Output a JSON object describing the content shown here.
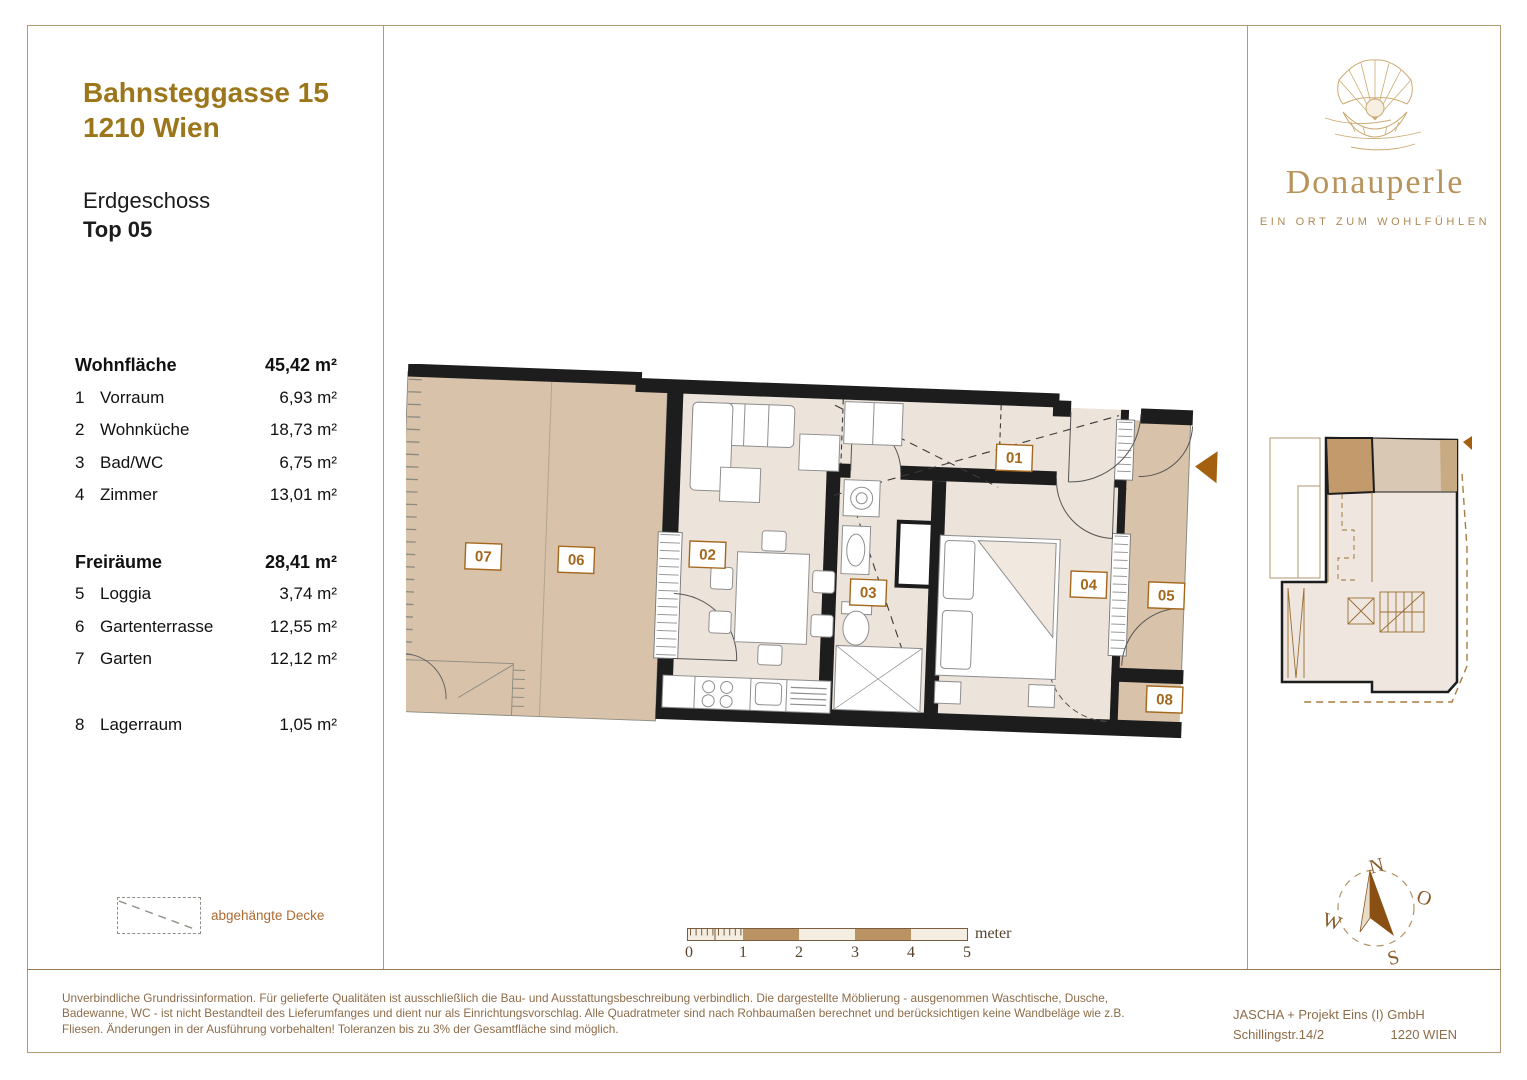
{
  "header": {
    "address_line1": "Bahnsteggasse 15",
    "address_line2": "1210 Wien",
    "floor": "Erdgeschoss",
    "unit": "Top 05"
  },
  "areas": {
    "living": {
      "label": "Wohnfläche",
      "total": "45,42 m²",
      "rows": [
        {
          "no": "1",
          "name": "Vorraum",
          "area": "6,93 m²"
        },
        {
          "no": "2",
          "name": "Wohnküche",
          "area": "18,73 m²"
        },
        {
          "no": "3",
          "name": "Bad/WC",
          "area": "6,75 m²"
        },
        {
          "no": "4",
          "name": "Zimmer",
          "area": "13,01 m²"
        }
      ]
    },
    "open": {
      "label": "Freiräume",
      "total": "28,41 m²",
      "rows": [
        {
          "no": "5",
          "name": "Loggia",
          "area": "3,74 m²"
        },
        {
          "no": "6",
          "name": "Gartenterrasse",
          "area": "12,55 m²"
        },
        {
          "no": "7",
          "name": "Garten",
          "area": "12,12 m²"
        }
      ]
    },
    "storage_row": {
      "no": "8",
      "name": "Lagerraum",
      "area": "1,05 m²"
    }
  },
  "legend": {
    "label": "abgehängte Decke"
  },
  "plan": {
    "labels": [
      "01",
      "02",
      "03",
      "04",
      "05",
      "06",
      "07",
      "08"
    ]
  },
  "scalebar": {
    "ticks": [
      "0",
      "1",
      "2",
      "3",
      "4",
      "5"
    ],
    "unit": "meter"
  },
  "compass": {
    "n": "N",
    "o": "O",
    "s": "S",
    "w": "W"
  },
  "logo": {
    "name": "Donauperle",
    "tagline": "EIN ORT ZUM WOHLFÜHLEN"
  },
  "footer": {
    "disclaimer_lines": [
      "Unverbindliche Grundrissinformation. Für gelieferte Qualitäten ist ausschließlich die Bau- und Ausstattungsbeschreibung verbindlich. Die dargestellte Möblierung - ausgenommen Waschtische, Dusche,",
      "Badewanne, WC - ist nicht Bestandteil des Lieferumfanges und dient nur als Einrichtungsvorschlag. Alle Quadratmeter sind nach Rohbaumaßen berechnet und berücksichtigen keine Wandbeläge wie z.B.",
      "Fliesen. Änderungen in der Ausführung vorbehalten! Toleranzen bis zu 3% der Gesamtfläche sind möglich."
    ],
    "company": "JASCHA + Projekt Eins (I) GmbH",
    "street": "Schillingstr.14/2",
    "city": "1220 WIEN"
  },
  "colors": {
    "accent_gold": "#9c761b",
    "logo_gold": "#b8935a",
    "room_label_brown": "#a5671c",
    "outdoor_tan": "#d8c2aa",
    "interior_beige": "#ece3da",
    "wall_black": "#1d1d1d",
    "frame_tan": "#b49a74",
    "footer_brown": "#8d6c49"
  }
}
